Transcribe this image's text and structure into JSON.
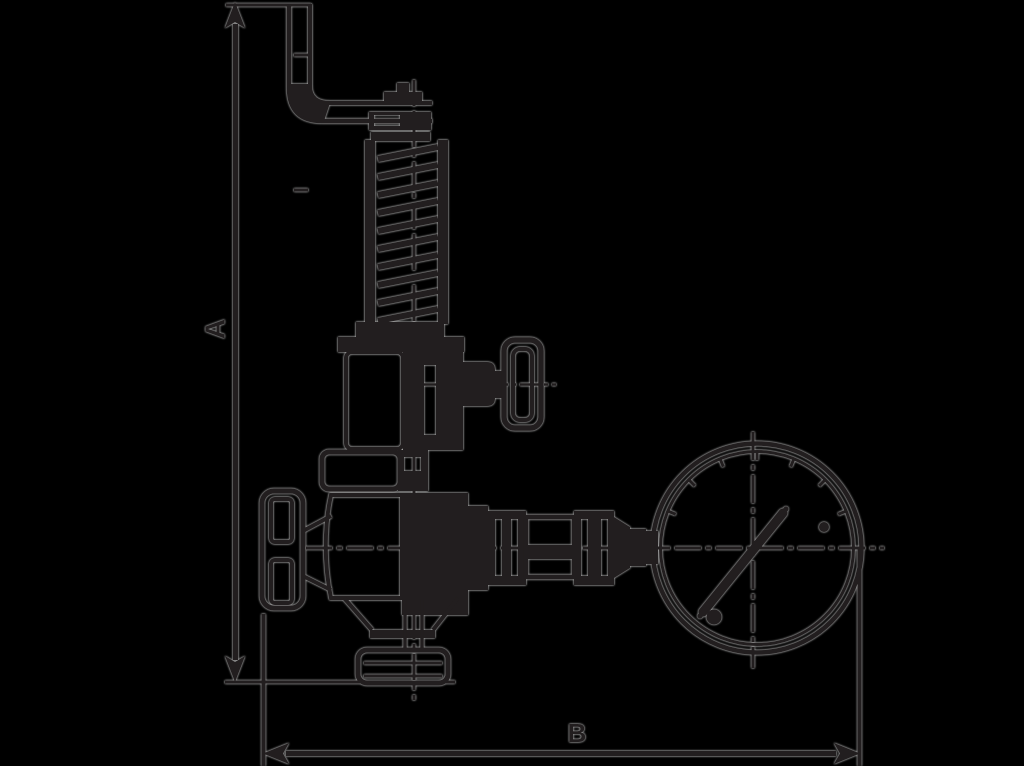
{
  "canvas": {
    "width_px": 1024,
    "height_px": 766,
    "background_color": "#000000",
    "ink_color": "#221e1f",
    "halo_color": "#b0b0b0"
  },
  "figure": {
    "type": "technical-drawing",
    "description": "Sectional side view of a spring-loaded back-pressure relief valve with test lever, spring housing, side test-valve handwheel, main handwheel, outlet union and attached pressure gauge",
    "dimension_labels": {
      "vertical": "A",
      "horizontal": "B"
    },
    "parts": [
      "test-lever",
      "adjusting-cap",
      "spring-housing",
      "spring-coil",
      "bonnet",
      "side-test-valve",
      "side-handwheel",
      "mounting-flange",
      "main-handwheel",
      "valve-body",
      "outlet-union",
      "gauge-piping",
      "union-nuts",
      "pressure-gauge",
      "gauge-needle",
      "gauge-stop-pin"
    ]
  }
}
